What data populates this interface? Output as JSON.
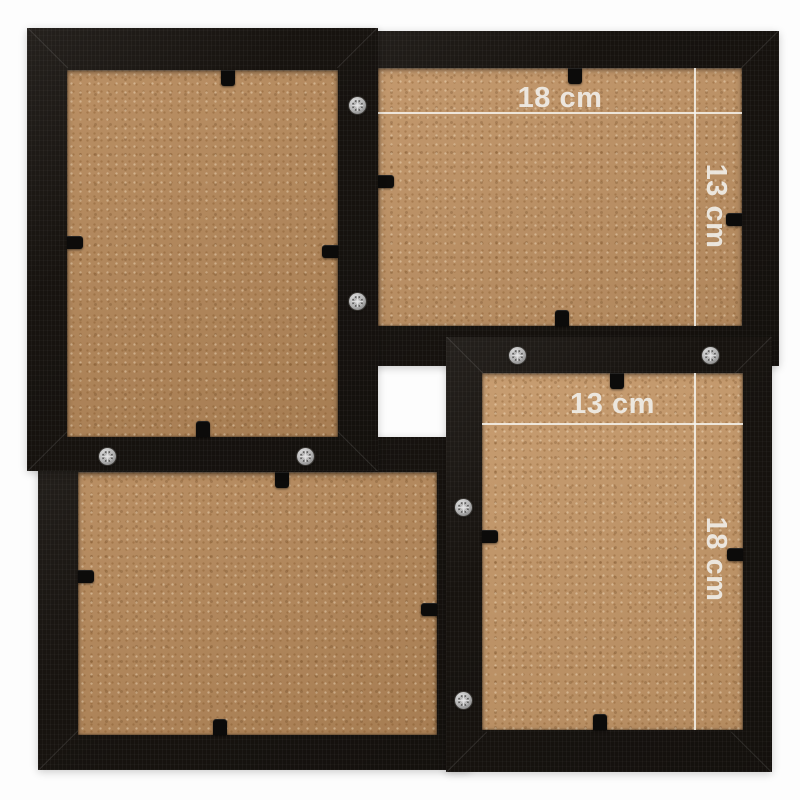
{
  "scene": {
    "annotations": {
      "top_right_frame": {
        "width_label": "18 cm",
        "height_label": "13 cm"
      },
      "bottom_right_frame": {
        "width_label": "13 cm",
        "height_label": "18 cm"
      }
    },
    "colors": {
      "background": "#fdfdfd",
      "frame_black": "#17130f",
      "backing_board_tan": "#b5885a",
      "backing_board_tan_light": "#c49768",
      "annotation_white": "#f0ede7",
      "screw_silver": "#b3b3b3",
      "clip_black": "#0c0b0a"
    }
  }
}
